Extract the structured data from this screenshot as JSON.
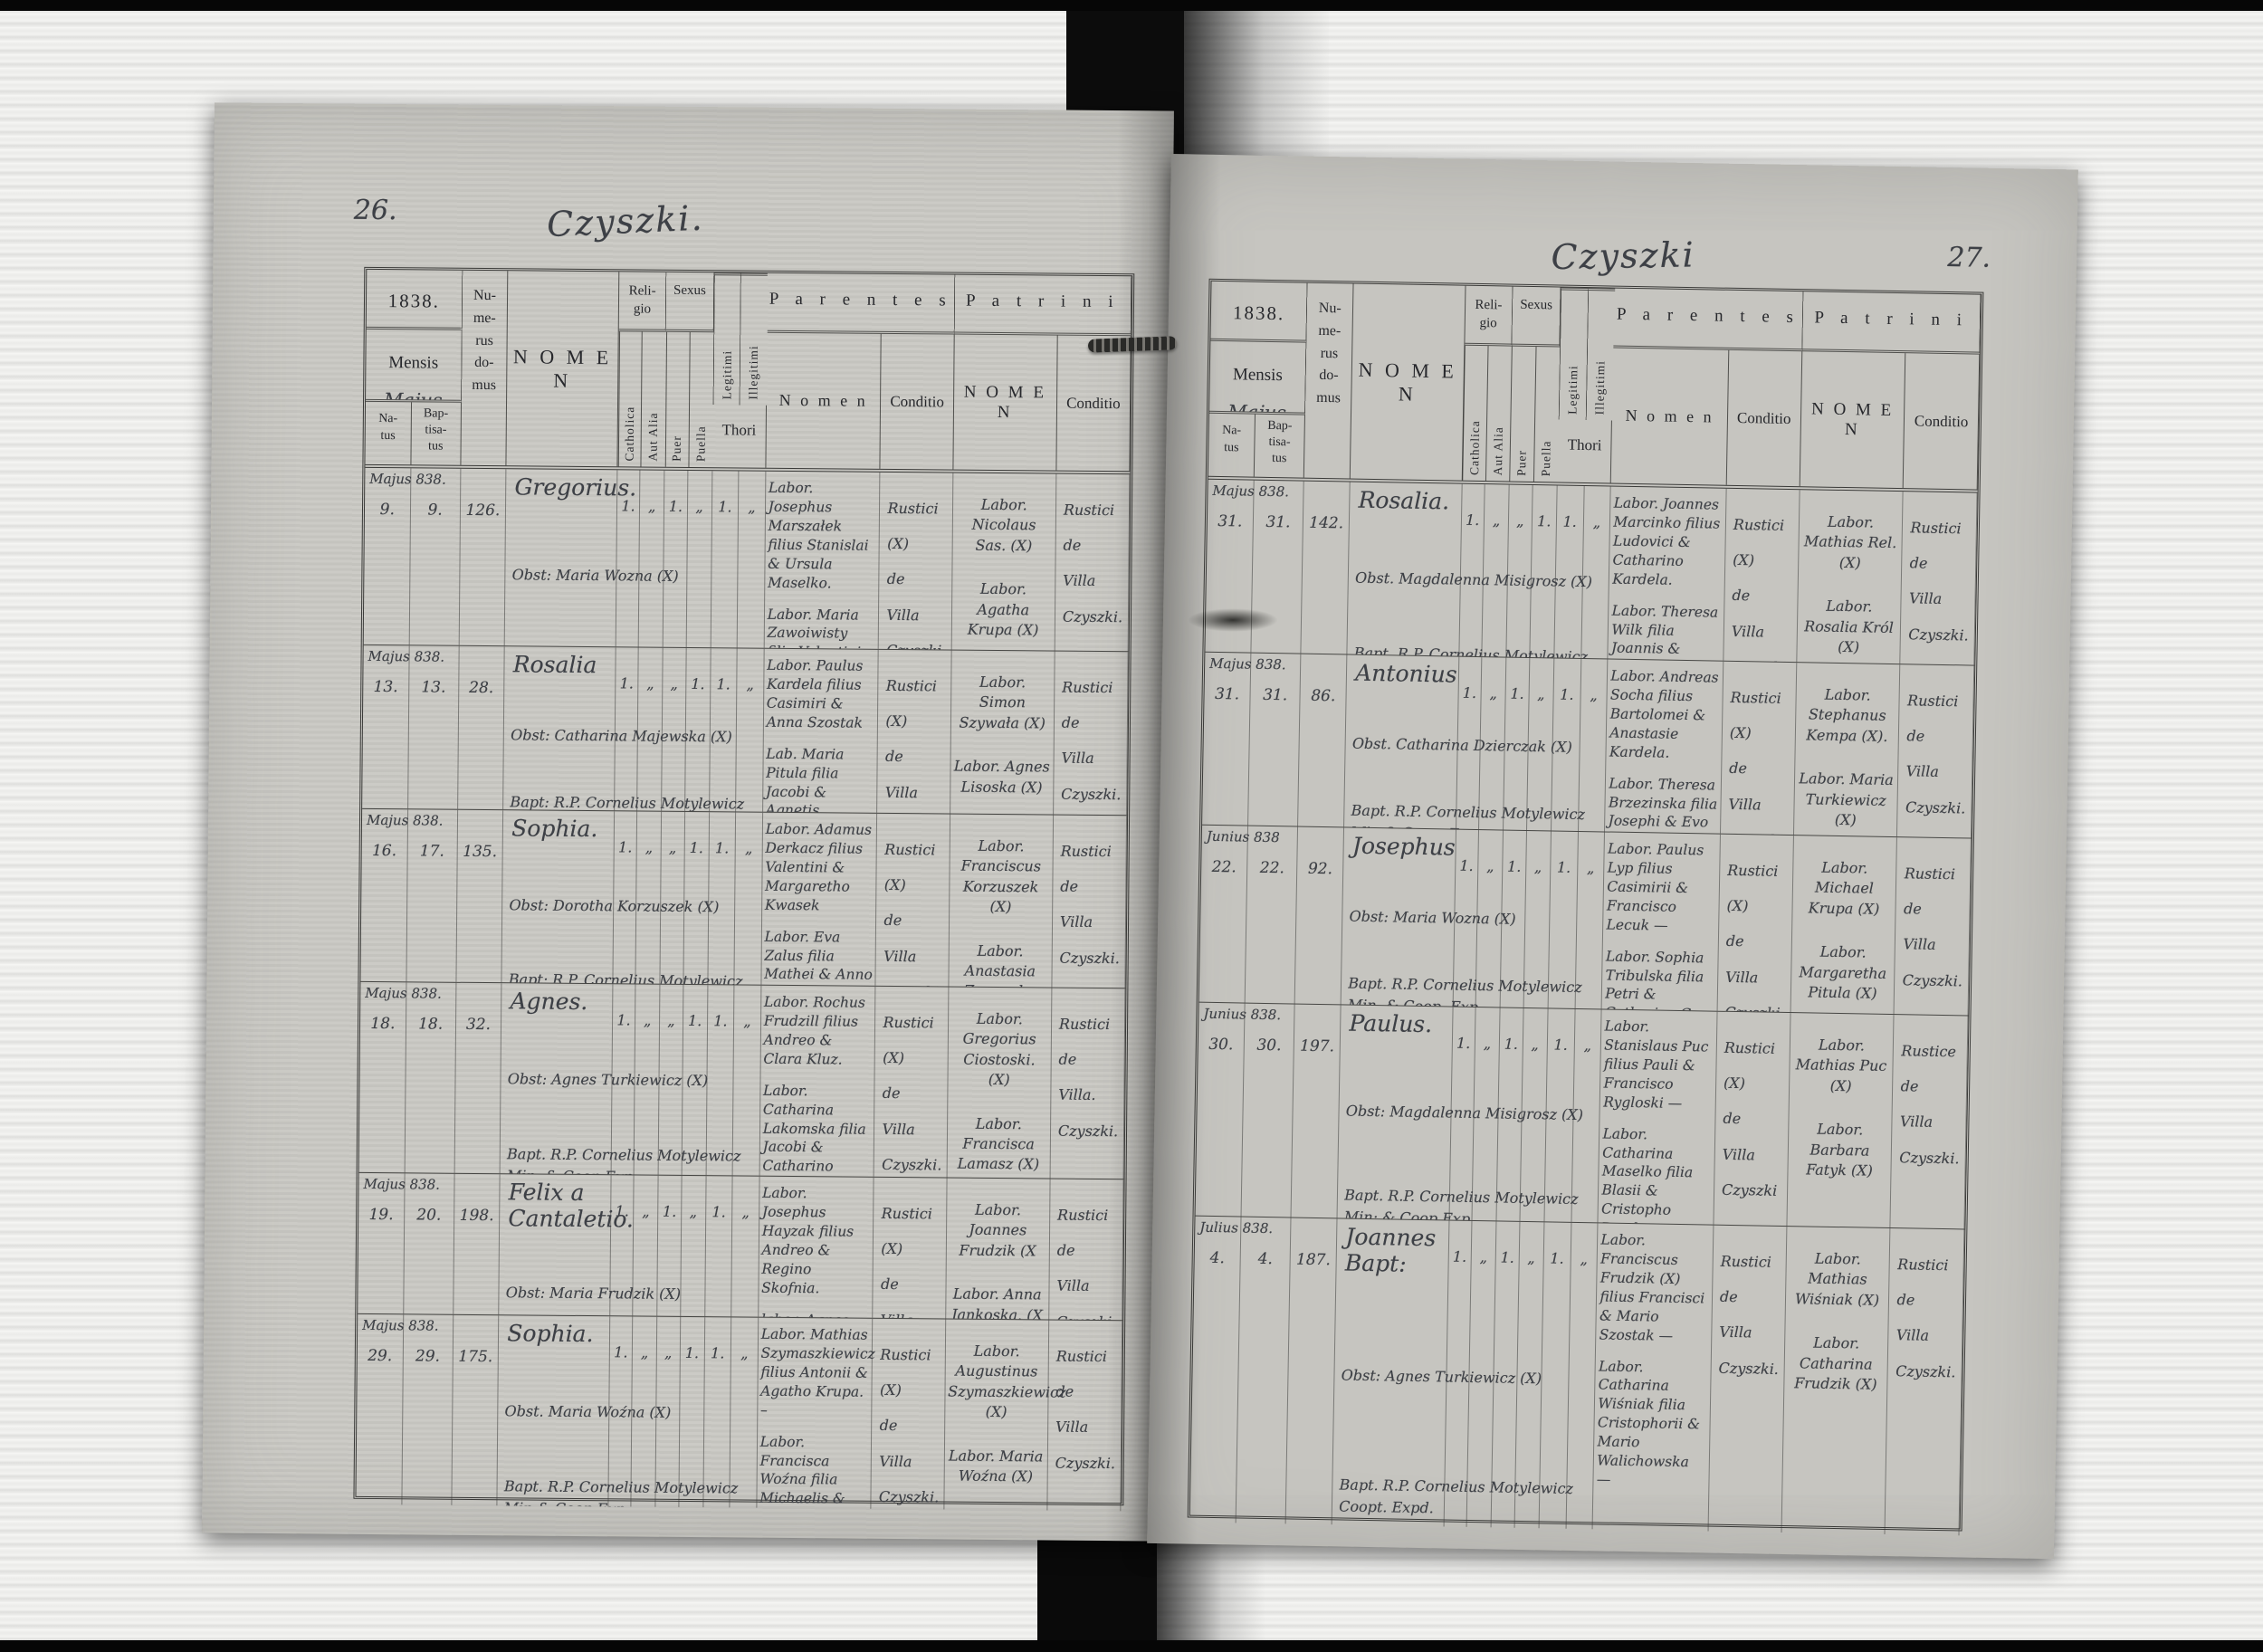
{
  "scan": {
    "left_page_number": "26.",
    "right_page_number": "27.",
    "left_title": "Czyszki.",
    "right_title": "Czyszki"
  },
  "header": {
    "year": "1838.",
    "mensis_label": "Mensis",
    "mensis_value": "Majus",
    "natus": "Na-\ntus",
    "baptisatus": "Bap-\ntisa-\ntus",
    "numerus_domus": "Nu-\nme-\nrus\ndo-\nmus",
    "nomen": "N O M E N",
    "religio": "Reli-\ngio",
    "catholica": "Catholica",
    "aut_alia": "Aut Alia",
    "sexus": "Sexus",
    "puer": "Puer",
    "puella": "Puella",
    "legitimi": "Legitimi",
    "illegitimi": "Illegitimi",
    "thori": "Thori",
    "parentes": "P a r e n t e s",
    "parentes_nomen": "N o m e n",
    "conditio": "Conditio",
    "patrini": "P a t r i n i",
    "patrini_nomen": "N O M E N"
  },
  "pages": [
    {
      "records": [
        {
          "month": "Majus 838.",
          "natus": "9.",
          "baptisatus": "9.",
          "domus": "126.",
          "nomen": "Gregorius.",
          "obst": "Obst: Maria Wozna (X)",
          "bapt": "Bapt. R.P. Cornelius Motylewicz\nMin: & Coop: Exp.",
          "ticks": [
            "1.",
            "„",
            "1.",
            "„",
            "1.",
            "„"
          ],
          "father": "Labor. Josephus Marszałek filius Stanislai & Ursula Maselko.",
          "mother": "Labor. Maria Zawoiwisty filia Valentini & Catharina Krupa.",
          "parentes_conditio": "Rustici (X)\nde\nVilla\nCzyszki.",
          "patrini_1": "Labor. Nicolaus Sas. (X)",
          "patrini_2": "Labor. Agatha Krupa (X)",
          "patrini_conditio": "Rustici\nde\nVilla\nCzyszki."
        },
        {
          "month": "Majus 838.",
          "natus": "13.",
          "baptisatus": "13.",
          "domus": "28.",
          "nomen": "Rosalia",
          "obst": "Obst: Catharina Majewska (X)",
          "bapt": "Bapt: R.P. Cornelius Motylewicz\nMin: & Coop Exp.",
          "ticks": [
            "1.",
            "„",
            "„",
            "1.",
            "1.",
            "„"
          ],
          "father": "Labor. Paulus Kardela filius Casimiri & Anna Szostak",
          "mother": "Lab. Maria Pitula filia Jacobi & Agnetis Ciostowski.",
          "parentes_conditio": "Rustici (X)\nde\nVilla\nCzyszki.",
          "patrini_1": "Labor. Simon Szywała (X)",
          "patrini_2": "Labor. Agnes Lisoska (X)",
          "patrini_conditio": "Rustici\nde\nVilla\nCzyszki."
        },
        {
          "month": "Majus 838.",
          "natus": "16.",
          "baptisatus": "17.",
          "domus": "135.",
          "nomen": "Sophia.",
          "obst": "Obst: Dorotha Korzuszek (X)",
          "bapt": "Bapt: R.P. Cornelius Motylewicz\nMin: & Coop: Exp.",
          "ticks": [
            "1.",
            "„",
            "„",
            "1.",
            "1.",
            "„"
          ],
          "father": "Labor. Adamus Derkacz filius Valentini & Margaretho Kwasek",
          "mother": "Labor. Eva Zalus filia Mathei & Anno Rutka —",
          "parentes_conditio": "Rustici (X)\nde\nVilla\nCzyszki",
          "patrini_1": "Labor. Franciscus Korzuszek (X)",
          "patrini_2": "Labor. Anastasia Zaworska (X)",
          "patrini_conditio": "Rustici\nde\nVilla\nCzyszki."
        },
        {
          "month": "Majus 838.",
          "natus": "18.",
          "baptisatus": "18.",
          "domus": "32.",
          "nomen": "Agnes.",
          "obst": "Obst: Agnes Turkiewicz (X)",
          "bapt": "Bapt. R.P. Cornelius Motylewicz\nMin: & Coop Exp.",
          "ticks": [
            "1.",
            "„",
            "„",
            "1.",
            "1.",
            "„"
          ],
          "father": "Labor. Rochus Frudzill filius Andreo & Clara Kluz.",
          "mother": "Labor. Catharina Lakomska filia Jacobi & Catharino Parina.",
          "parentes_conditio": "Rustici (X)\nde\nVilla\nCzyszki.",
          "patrini_1": "Labor. Gregorius Ciostoski. (X)",
          "patrini_2": "Labor. Francisca Lamasz (X)",
          "patrini_conditio": "Rustici\nde\nVilla.\nCzyszki."
        },
        {
          "month": "Majus 838.",
          "natus": "19.",
          "baptisatus": "20.",
          "domus": "198.",
          "nomen": "Felix a\nCantaletio.",
          "obst": "Obst: Maria Frudzik (X)",
          "bapt": "Bapt. R.P. Cornelius Motylewicz\nMin: & Coop. Exp.",
          "ticks": [
            "1.",
            "„",
            "1.",
            "„",
            "1.",
            "„"
          ],
          "father": "Labor. Josephus Hayzak filius Andreo & Regino Skofnia.",
          "mother": "labor. Agnes Dombroska filia Martini & Regino Sokoloski",
          "parentes_conditio": "Rustici (X)\nde\nVilla\nCzyszki",
          "patrini_1": "Labor. Joannes Frudzik (X",
          "patrini_2": "Labor. Anna Jankoska. (X",
          "patrini_conditio": "Rustici\nde\nVilla\nCzyszki."
        },
        {
          "month": "Majus 838.",
          "natus": "29.",
          "baptisatus": "29.",
          "domus": "175.",
          "nomen": "Sophia.",
          "obst": "Obst. Maria Woźna (X)",
          "bapt": "Bapt. R.P. Cornelius Motylewicz\nMin & Coop Exp.",
          "ticks": [
            "1.",
            "„",
            "„",
            "1.",
            "1.",
            "„"
          ],
          "father": "Labor. Mathias Szymaszkiewicz filius Antonii & Agatho Krupa. –",
          "mother": "Labor. Francisca Woźna filia Michaelis & Maria Rec. —",
          "parentes_conditio": "Rustici (X)\nde\nVilla\nCzyszki.",
          "patrini_1": "Labor. Augustinus Szymaszkiewicz (X)",
          "patrini_2": "Labor. Maria Woźna (X)",
          "patrini_conditio": "Rustici\nde\nVilla\nCzyszki."
        }
      ]
    },
    {
      "records": [
        {
          "month": "Majus 838.",
          "natus": "31.",
          "baptisatus": "31.",
          "domus": "142.",
          "nomen": "Rosalia.",
          "obst": "Obst. Magdalenna Misigrosz (X)",
          "bapt": "Bapt. R.P. Cornelius Motylewicz\nMin. & Coop. Exp.",
          "ticks": [
            "1.",
            "„",
            "„",
            "1.",
            "1.",
            "„"
          ],
          "father": "Labor. Joannes Marcinko filius Ludovici & Catharino Kardela.",
          "mother": "Labor. Theresa Wilk filia Joannis & Regino Walichnowski.",
          "parentes_conditio": "Rustici (X)\nde\nVilla\nCzyszki.",
          "patrini_1": "Labor. Mathias Rel. (X)",
          "patrini_2": "Labor. Rosalia Król (X)",
          "patrini_conditio": "Rustici\nde\nVilla\nCzyszki."
        },
        {
          "month": "Majus 838.",
          "natus": "31.",
          "baptisatus": "31.",
          "domus": "86.",
          "nomen": "Antonius",
          "obst": "Obst. Catharina Dzierczak (X)",
          "bapt": "Bapt. R.P. Cornelius Motylewicz\nMin & Coop. Exp.",
          "ticks": [
            "1.",
            "„",
            "1.",
            "„",
            "1.",
            "„"
          ],
          "father": "Labor. Andreas Socha filius Bartolomei & Anastasie Kardela.",
          "mother": "Labor. Theresa Brzezinska filia Josephi & Evo Bartosiewicz.",
          "parentes_conditio": "Rustici (X)\nde\nVilla\nCzyszki.",
          "patrini_1": "Labor. Stephanus Kempa (X).",
          "patrini_2": "Labor. Maria Turkiewicz (X)",
          "patrini_conditio": "Rustici\nde\nVilla\nCzyszki."
        },
        {
          "month": "Junius 838",
          "natus": "22.",
          "baptisatus": "22.",
          "domus": "92.",
          "nomen": "Josephus",
          "obst": "Obst: Maria Wozna (X)",
          "bapt": "Bapt. R.P. Cornelius Motylewicz\nMin. & Coop. Exp.",
          "ticks": [
            "1.",
            "„",
            "1.",
            "„",
            "1.",
            "„"
          ],
          "father": "Labor. Paulus Lyp filius Casimirii & Francisco Lecuk —",
          "mother": "Labor. Sophia Tribulska filia Petri & Catharino Gas.",
          "parentes_conditio": "Rustici (X)\nde\nVilla\nCzyszki.",
          "patrini_1": "Labor. Michael Krupa (X)",
          "patrini_2": "Labor. Margaretha Pitula (X)",
          "patrini_conditio": "Rustici\nde\nVilla\nCzyszki."
        },
        {
          "month": "Junius 838.",
          "natus": "30.",
          "baptisatus": "30.",
          "domus": "197.",
          "nomen": "Paulus.",
          "obst": "Obst: Magdalenna Misigrosz (X)",
          "bapt": "Bapt. R.P. Cornelius Motylewicz\nMin: & Coop Exp.",
          "ticks": [
            "1.",
            "„",
            "1.",
            "„",
            "1.",
            "„"
          ],
          "father": "Labor. Stanislaus Puc filius Pauli & Francisco Rygloski —",
          "mother": "Labor. Catharina Maselko filia Blasii & Cristopho Bombata —",
          "parentes_conditio": "Rustici (X)\nde\nVilla\nCzyszki",
          "patrini_1": "Labor. Mathias Puc (X)",
          "patrini_2": "Labor. Barbara Fatyk (X)",
          "patrini_conditio": "Rustice\nde\nVilla\nCzyszki."
        },
        {
          "month": "Julius 838.",
          "natus": "4.",
          "baptisatus": "4.",
          "domus": "187.",
          "nomen": "Joannes\nBapt:",
          "obst": "Obst: Agnes Turkiewicz (X)",
          "bapt": "Bapt. R.P. Cornelius Motylewicz\nCoopt. Expd.",
          "ticks": [
            "1.",
            "„",
            "1.",
            "„",
            "1.",
            "„"
          ],
          "father": "Labor. Franciscus Frudzik (X) filius Francisci & Mario Szostak —",
          "mother": "Labor. Catharina Wiśniak filia Cristophorii & Mario Walichowska —",
          "parentes_conditio": "Rustici\nde\nVilla\nCzyszki.",
          "patrini_1": "Labor. Mathias Wiśniak (X)",
          "patrini_2": "Labor. Catharina Frudzik (X)",
          "patrini_conditio": "Rustici\nde\nVilla\nCzyszki."
        }
      ]
    }
  ]
}
